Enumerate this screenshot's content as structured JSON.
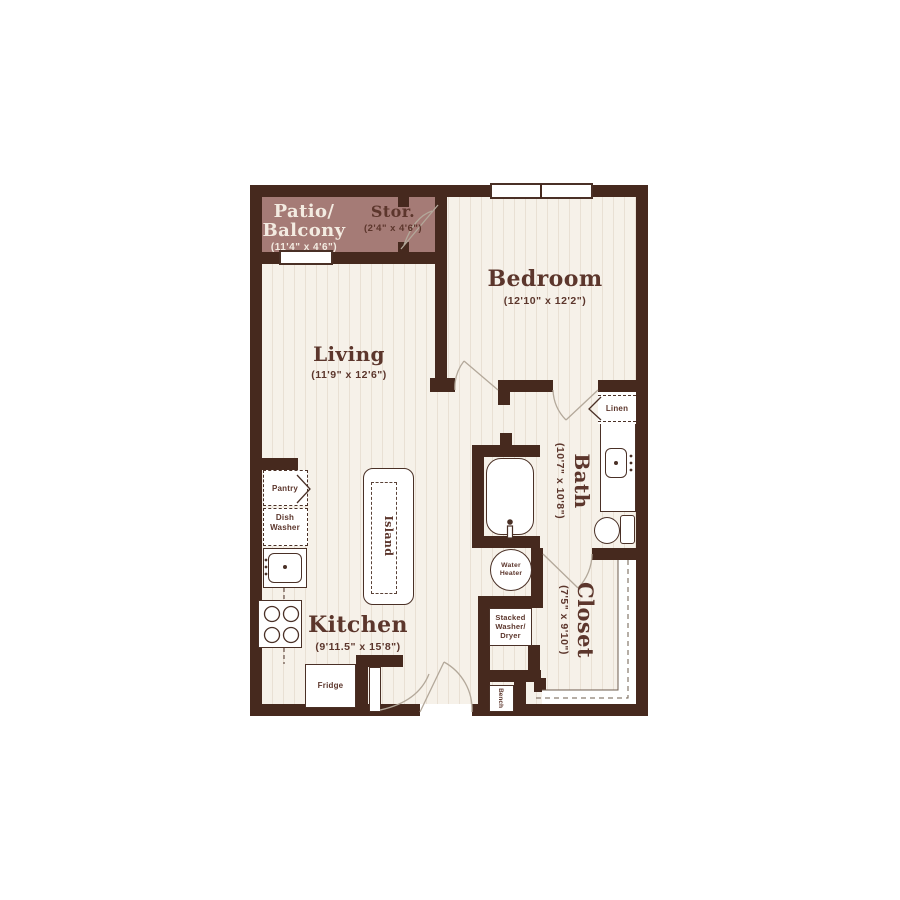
{
  "rooms": {
    "patio": {
      "line1": "Patio/",
      "line2": "Balcony",
      "dims": "(11'4\" x 4'6\")"
    },
    "storage": {
      "title": "Stor.",
      "dims": "(2'4\" x 4'6\")"
    },
    "bedroom": {
      "title": "Bedroom",
      "dims": "(12'10\" x 12'2\")"
    },
    "living": {
      "title": "Living",
      "dims": "(11'9\" x 12'6\")"
    },
    "bath": {
      "title": "Bath",
      "dims": "(10'7\" x 10'8\")"
    },
    "kitchen": {
      "title": "Kitchen",
      "dims": "(9'11.5\" x 15'8\")"
    },
    "closet": {
      "title": "Closet",
      "dims": "(7'5\" x 9'10\")"
    }
  },
  "fixtures": {
    "pantry": "Pantry",
    "dishwasher_line1": "Dish",
    "dishwasher_line2": "Washer",
    "island": "Island",
    "fridge": "Fridge",
    "linen": "Linen",
    "water_heater_line1": "Water",
    "water_heater_line2": "Heater",
    "washer_dryer_line1": "Stacked",
    "washer_dryer_line2": "Washer/",
    "washer_dryer_line3": "Dryer",
    "bench": "Bench"
  },
  "colors": {
    "wall": "#46291e",
    "patio": "#a57b76",
    "floor": "#f6f1e9",
    "stripe": "#e9e0d4",
    "line": "#4a3026",
    "door": "#b3a89a",
    "label": "#5c362c",
    "patiotext": "#f3ebe1",
    "white": "#ffffff"
  }
}
